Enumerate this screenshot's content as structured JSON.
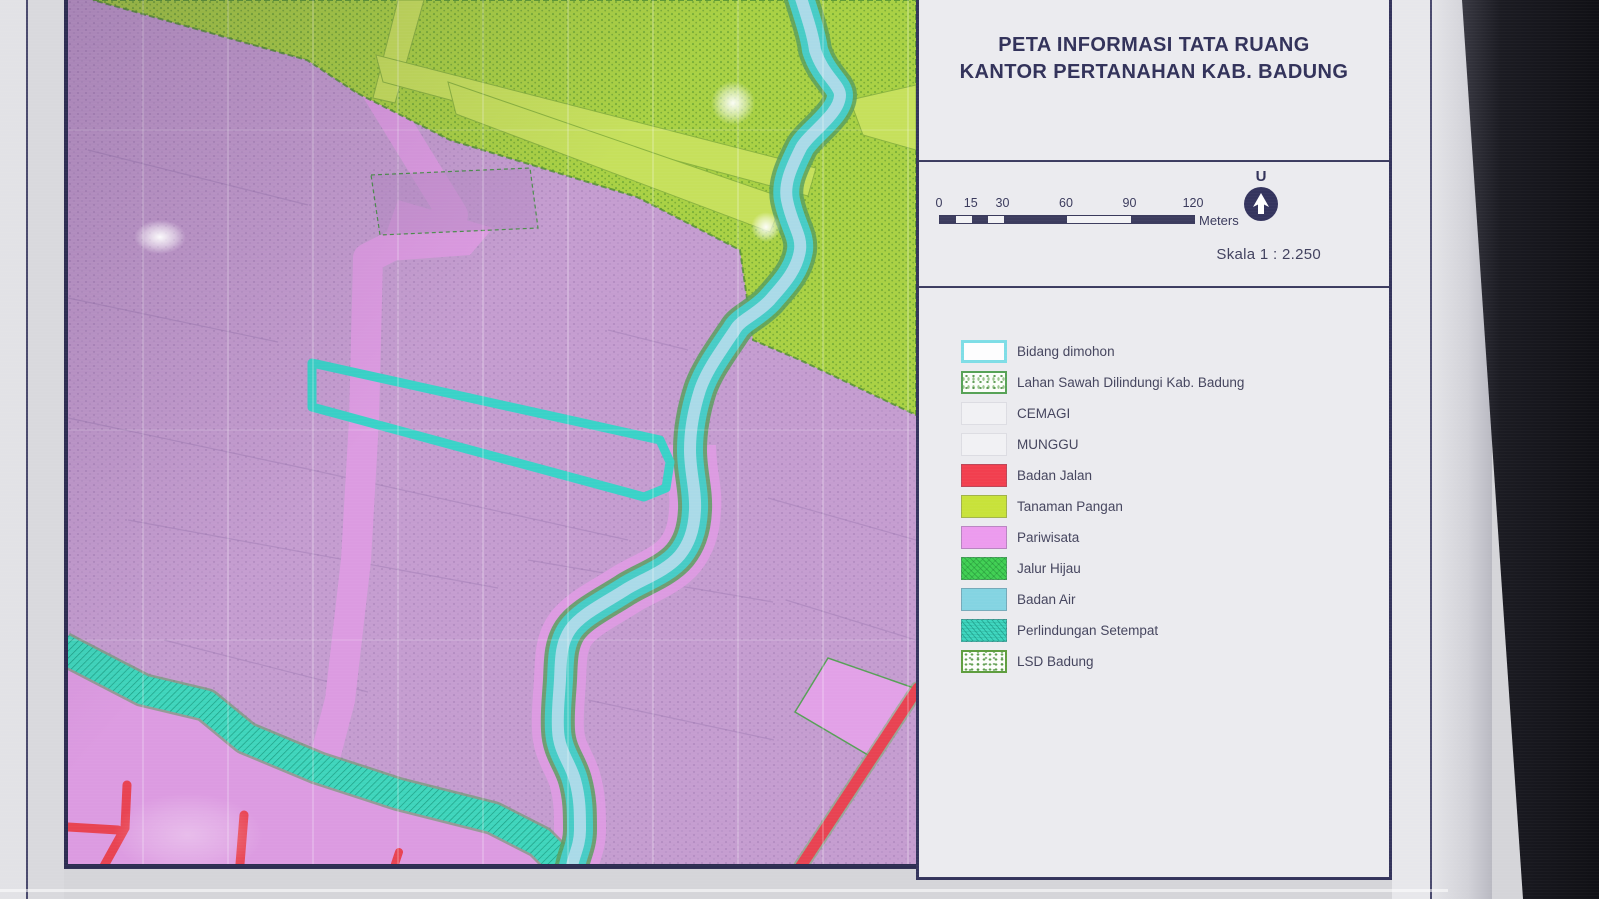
{
  "panel": {
    "title_line1": "PETA INFORMASI TATA RUANG",
    "title_line2": "KANTOR PERTANAHAN KAB. BADUNG",
    "north_label": "U",
    "scale_text": "Skala 1 : 2.250",
    "scalebar": {
      "values": [
        "0",
        "15",
        "30",
        "60",
        "90",
        "120"
      ],
      "max": 120,
      "unit": "Meters",
      "segments": [
        {
          "from": 0,
          "to": 7.5,
          "tone": "dark"
        },
        {
          "from": 7.5,
          "to": 15,
          "tone": "light"
        },
        {
          "from": 15,
          "to": 22.5,
          "tone": "dark"
        },
        {
          "from": 22.5,
          "to": 30,
          "tone": "light"
        },
        {
          "from": 30,
          "to": 60,
          "tone": "dark"
        },
        {
          "from": 60,
          "to": 90,
          "tone": "light"
        },
        {
          "from": 90,
          "to": 120,
          "tone": "dark"
        }
      ]
    },
    "legend": [
      {
        "label": "Bidang dimohon",
        "swatch": "outline-cyan"
      },
      {
        "label": "Lahan Sawah Dilindungi Kab. Badung",
        "swatch": "speckle-green"
      },
      {
        "label": "CEMAGI",
        "swatch": "blank"
      },
      {
        "label": "MUNGGU",
        "swatch": "blank"
      },
      {
        "label": "Badan Jalan",
        "swatch": "solid",
        "color": "#f23f4f"
      },
      {
        "label": "Tanaman Pangan",
        "swatch": "solid",
        "color": "#c8e23a"
      },
      {
        "label": "Pariwisata",
        "swatch": "solid",
        "color": "#ec9bee"
      },
      {
        "label": "Jalur Hijau",
        "swatch": "textured-green",
        "color": "#41d054"
      },
      {
        "label": "Badan Air",
        "swatch": "solid",
        "color": "#84d4e2"
      },
      {
        "label": "Perlindungan Setempat",
        "swatch": "hatch-teal",
        "color": "#3fd6bf"
      },
      {
        "label": "LSD Badung",
        "swatch": "speckle-lsd"
      }
    ]
  },
  "map": {
    "colors": {
      "pariwisata_purple": "#c59dd0",
      "pariwisata_bright_pink": "#dc9be1",
      "tanaman_pangan_green": "#a9d144",
      "tanaman_pangan_light_band": "#c6e05c",
      "river_teal": "#47ccc6",
      "river_center_blue": "#aadae8",
      "perlindungan_setempat_teal": "#3fd5bc",
      "badan_jalan_red": "#e84352",
      "bidang_dimohon_outline_cyan": "#3ad2c8",
      "frame_navy": "#2d2d52"
    }
  }
}
